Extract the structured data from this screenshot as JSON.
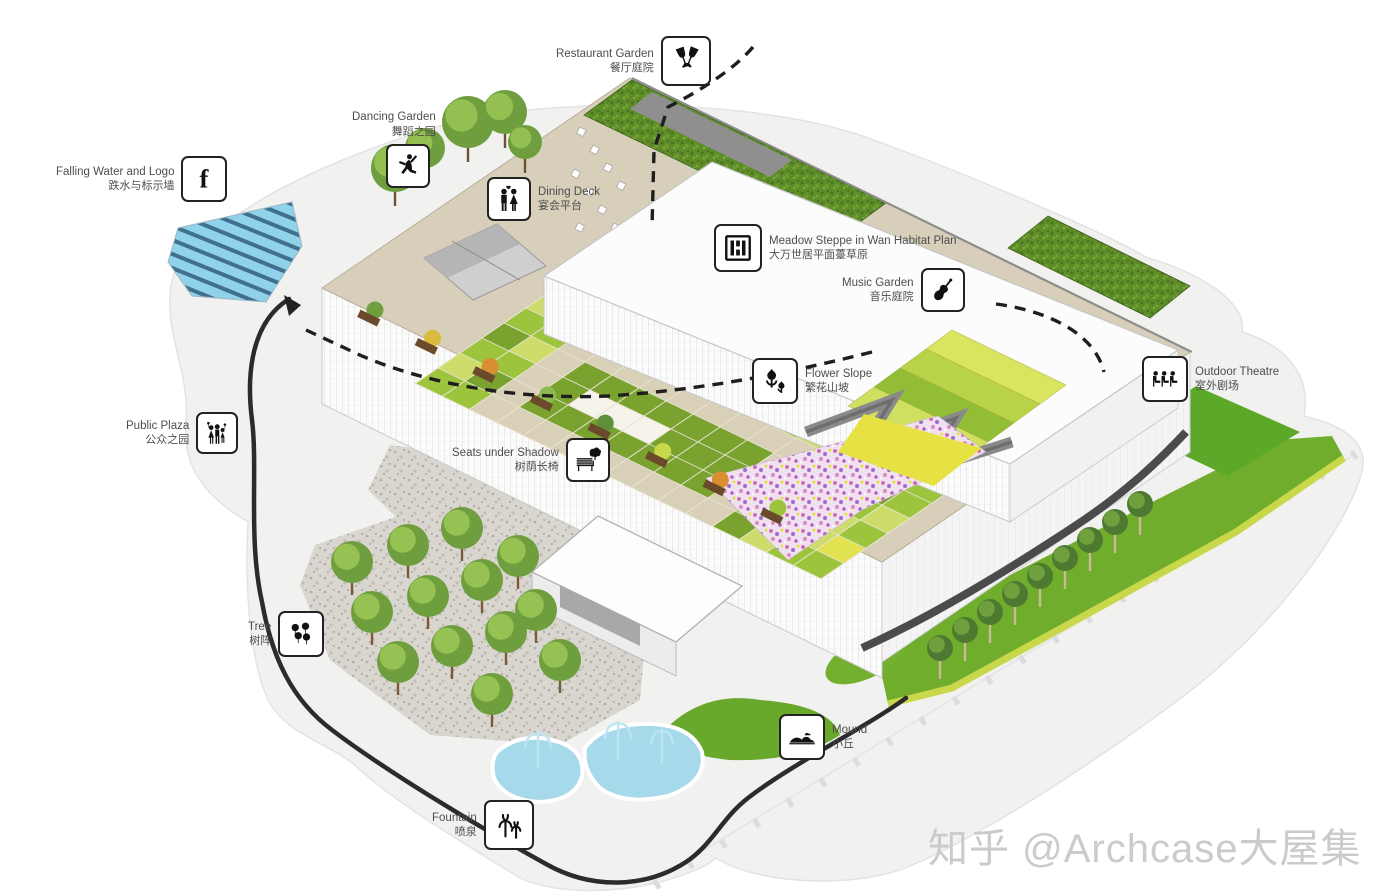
{
  "watermark": {
    "text": "知乎 @Archcase大屋集"
  },
  "labels": [
    {
      "en": "Restaurant Garden",
      "zh": "餐厅庭院",
      "icon": "wine-glasses-icon"
    },
    {
      "en": "Dancing Garden",
      "zh": "舞蹈之园",
      "icon": "dancer-icon"
    },
    {
      "en": "Falling Water and Logo",
      "zh": "跌水与标示墙",
      "icon": "letter-f-logo-icon",
      "icon_glyph": "f"
    },
    {
      "en": "Dining Deck",
      "zh": "宴会平台",
      "icon": "couple-icon"
    },
    {
      "en": "Meadow Steppe in Wan Habitat Plan",
      "zh": "大万世居平面薹草原",
      "icon": "seal-icon"
    },
    {
      "en": "Music Garden",
      "zh": "音乐庭院",
      "icon": "violin-icon"
    },
    {
      "en": "Flower Slope",
      "zh": "繁花山坡",
      "icon": "tulips-icon"
    },
    {
      "en": "Outdoor Theatre",
      "zh": "室外剧场",
      "icon": "audience-seats-icon"
    },
    {
      "en": "Public Plaza",
      "zh": "公众之园",
      "icon": "crowd-icon"
    },
    {
      "en": "Seats under Shadow",
      "zh": "树荫长椅",
      "icon": "bench-icon"
    },
    {
      "en": "Tree",
      "zh": "树阵",
      "icon": "tree-array-icon"
    },
    {
      "en": "Mound",
      "zh": "小丘",
      "icon": "mound-icon"
    },
    {
      "en": "Fountain",
      "zh": "喷泉",
      "icon": "fountain-icon"
    }
  ],
  "colors": {
    "ground": "#f1f1f0",
    "roof_deck": "#d8cfba",
    "meadow_mid_green": "#9cc43d",
    "meadow_dark_green": "#79a22f",
    "meadow_light_green": "#cddc6a",
    "meadow_yellow": "#e2e250",
    "lawn_green": "#70ad2c",
    "water_blue": "#8fd2ea",
    "path_black": "#2b2b2b",
    "label_text_gray": "#4e4e4e"
  }
}
